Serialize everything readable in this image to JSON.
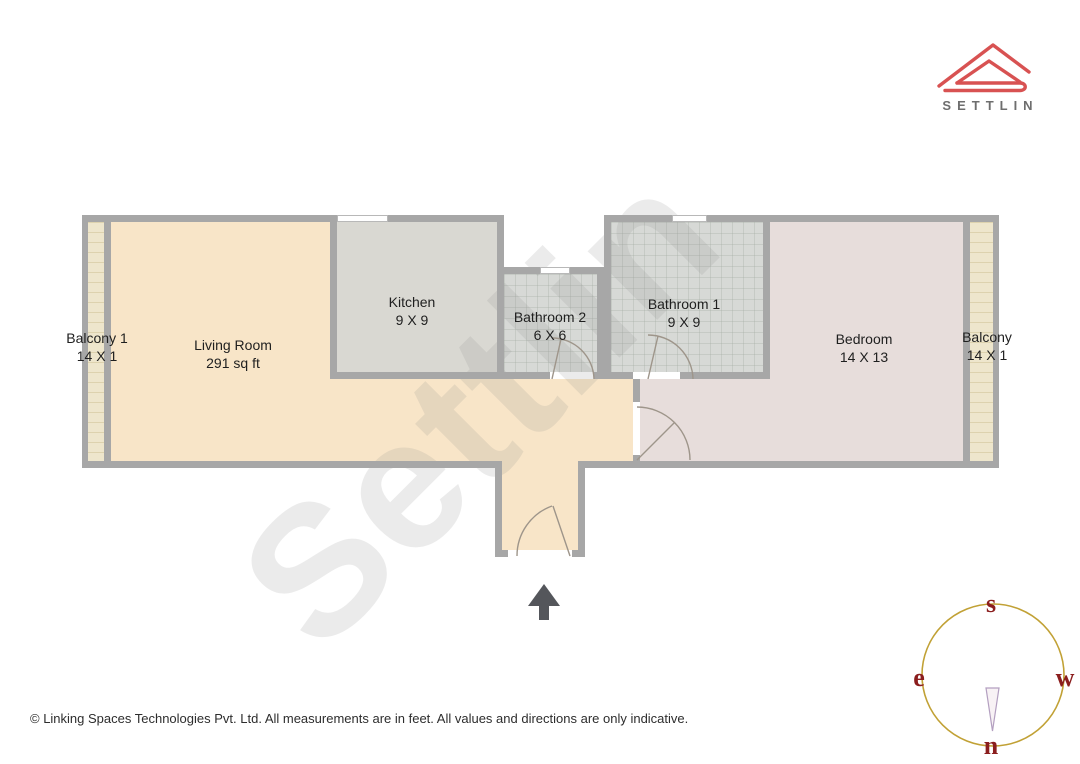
{
  "logo": {
    "brand": "SETTLIN"
  },
  "watermark": {
    "text": "Settlin"
  },
  "rooms": [
    {
      "id": "balcony1",
      "name": "Balcony 1",
      "dims": "14 X 1"
    },
    {
      "id": "living",
      "name": "Living Room",
      "dims": "291 sq ft"
    },
    {
      "id": "kitchen",
      "name": "Kitchen",
      "dims": "9 X 9"
    },
    {
      "id": "bathroom2",
      "name": "Bathroom 2",
      "dims": "6 X 6"
    },
    {
      "id": "bathroom1",
      "name": "Bathroom 1",
      "dims": "9 X 9"
    },
    {
      "id": "bedroom",
      "name": "Bedroom",
      "dims": "14 X 13"
    },
    {
      "id": "balcony2",
      "name": "Balcony",
      "dims": "14 X 1"
    }
  ],
  "compass": {
    "top": "s",
    "left": "e",
    "right": "w",
    "bottom": "n"
  },
  "footer": {
    "copyright": "© Linking Spaces Technologies Pvt. Ltd. All measurements are in feet. All values and directions are only indicative."
  },
  "colors": {
    "wall": "#a7a7a7",
    "living": "#f8e5c8",
    "kitchen": "#d9d8d2",
    "bathroom": "#d7d9d6",
    "bedroom": "#e7dddb",
    "balcony": "#eee6cc",
    "logo_red": "#d85252",
    "compass_ring": "#c1a135",
    "compass_letters": "#8b1e1e",
    "entry_arrow": "#54565b"
  }
}
